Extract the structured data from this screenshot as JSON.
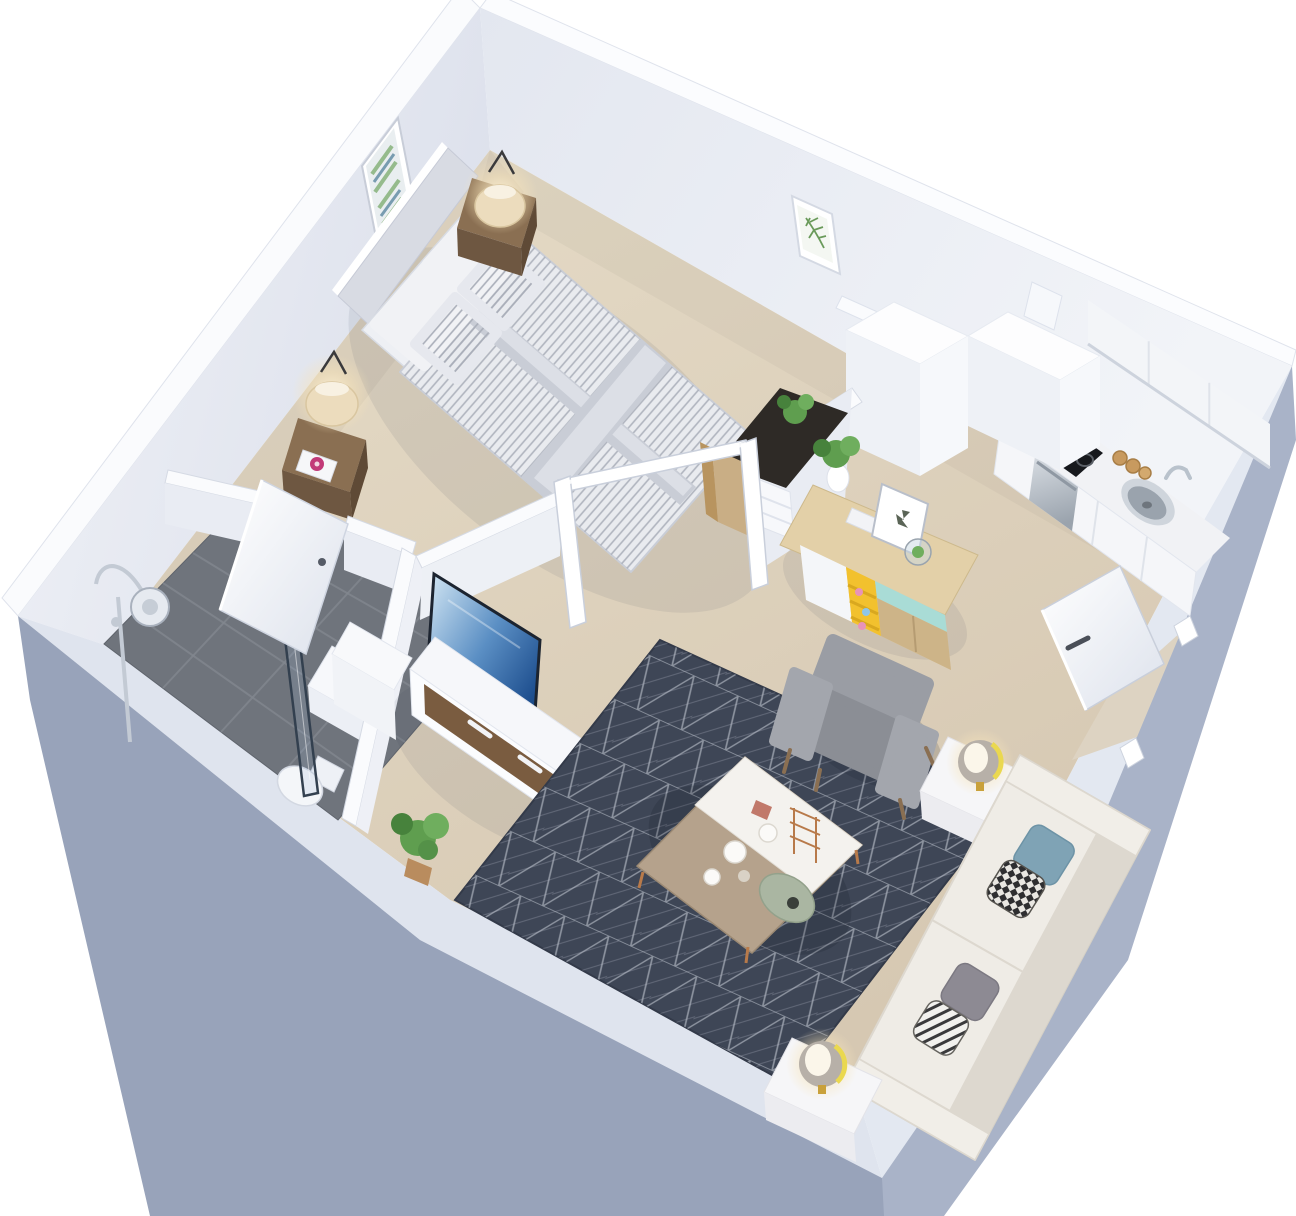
{
  "scene": {
    "kind": "3d-isometric-floor-plan",
    "description": "Studio apartment 3D floor plan render: bedroom (top-left), bathroom (left), kitchen (right), living room (bottom-right), desk nook and closet (center), entry door (right wall)",
    "rooms": [
      "bedroom",
      "bathroom",
      "kitchen",
      "living-room",
      "entry-hall"
    ]
  },
  "colors": {
    "bg": "#ffffff",
    "wallOuter": "#98a3ba",
    "wallOuterRight": "#a9b3c8",
    "wallBand": "#dfe4ee",
    "wallFaceLeft": "#e7eaf1",
    "wallFaceRight": "#eef1f6",
    "wallTopWhite": "#fafbfd",
    "slabFace": "#e9ecf3",
    "floor": "#dccfba",
    "floorLight": "#e6dcc8",
    "tile": "#6f747c",
    "tileLine": "#82878f",
    "rug": "#3e4656",
    "rugLine": "#ccd1db",
    "duvet": "#e9ebef",
    "duvetStripe": "#a9aeb9",
    "duvetBand": "#c9cdd6",
    "pillow": "#f1f2f5",
    "headboard": "#d8dbe3",
    "woodDark": "#6e5741",
    "woodMid": "#8a6f52",
    "woodLight": "#dbc69e",
    "woodBench": "#c9ae85",
    "deskTop": "#2e2a26",
    "yellow": "#f2c12e",
    "teal": "#a9dcd6",
    "armchair": "#9a9da4",
    "armchairDark": "#8b8e95",
    "sofa": "#eae7e0",
    "sofaCushion": "#efece6",
    "sofaDark": "#ddd8cf",
    "tableWood": "#b5a28c",
    "trayWhite": "#f4f2ee",
    "tvFrame": "#1c2430",
    "steel": "#c2c8d0",
    "cooktop": "#17191d",
    "gold": "#c9a13b",
    "lampShade": "#ecdcbd",
    "plant": "#5f9e4f",
    "plantDark": "#47823c",
    "chrome": "#c3cad4",
    "glassTint": "rgba(150,180,210,0.18)",
    "pillowBlue": "#7fa3b5",
    "pillowGray": "#8d8a93",
    "pinkFlower": "#c23a78",
    "shadow": "rgba(60,65,90,0.09)"
  },
  "inventory": {
    "bedroom": [
      "double-bed",
      "striped-duvet",
      "headboard",
      "nightstand-left",
      "nightstand-right",
      "table-lamp-left",
      "table-lamp-right",
      "abstract-wall-art",
      "bathroom-door"
    ],
    "bathroom": [
      "walk-in-shower",
      "shower-screen",
      "shower-fixture",
      "vanity",
      "toilet",
      "tiled-floor"
    ],
    "kitchen": [
      "upper-cabinets",
      "base-cabinets",
      "cooktop",
      "sink",
      "dishwasher",
      "wood-canisters",
      "sideboard",
      "butterfly-art",
      "terrarium",
      "pitcher-plant"
    ],
    "living": [
      "geometric-rug",
      "coffee-table",
      "armchair",
      "sofa",
      "throw-pillows",
      "side-table-upper",
      "side-table-lower",
      "sphere-lamp-upper",
      "sphere-lamp-lower",
      "tv",
      "tv-console",
      "floor-plant"
    ],
    "hall": [
      "desk-nook",
      "desk-plant",
      "drawer-unit",
      "wood-stool",
      "open-door-frame",
      "closet-volume",
      "entry-door"
    ]
  }
}
